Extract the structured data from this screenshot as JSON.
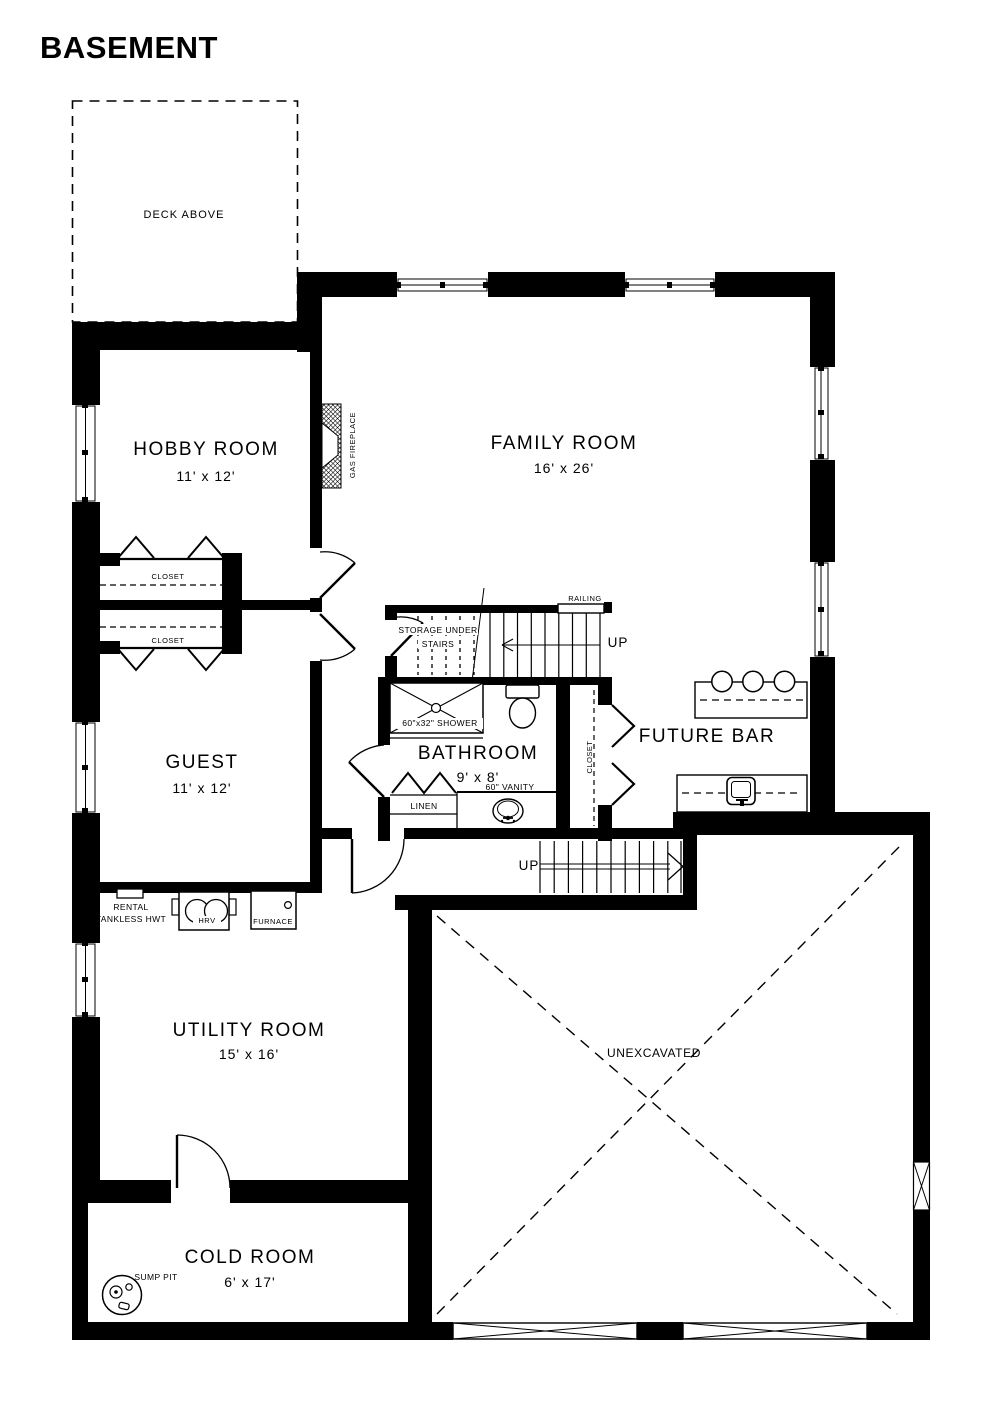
{
  "title": "BASEMENT",
  "colors": {
    "wall": "#000000",
    "background": "#ffffff",
    "ink": "#000000"
  },
  "rooms": {
    "deck": {
      "label": "DECK ABOVE"
    },
    "hobby": {
      "name": "HOBBY ROOM",
      "dims": "11' x 12'"
    },
    "family": {
      "name": "FAMILY ROOM",
      "dims": "16' x 26'"
    },
    "guest": {
      "name": "GUEST",
      "dims": "11' x 12'"
    },
    "bathroom": {
      "name": "BATHROOM",
      "dims": "9' x 8'"
    },
    "utility": {
      "name": "UTILITY ROOM",
      "dims": "15' x 16'"
    },
    "cold": {
      "name": "COLD ROOM",
      "dims": "6' x 17'"
    },
    "future_bar": {
      "name": "FUTURE BAR"
    },
    "unexcavated": {
      "name": "UNEXCAVATED"
    }
  },
  "features": {
    "gas_fireplace": "GAS FIREPLACE",
    "closet_upper": "CLOSET",
    "closet_lower": "CLOSET",
    "closet_bath": "CLOSET",
    "storage_line1": "STORAGE UNDER",
    "storage_line2": "STAIRS",
    "railing": "RAILING",
    "up_main": "UP",
    "up_entry": "UP",
    "shower": "60\"x32\" SHOWER",
    "vanity": "60\" VANITY",
    "linen": "LINEN",
    "rental_line1": "RENTAL",
    "rental_line2": "TANKLESS HWT",
    "hrv": "HRV",
    "furnace": "FURNACE",
    "sump_pit": "SUMP PIT"
  }
}
